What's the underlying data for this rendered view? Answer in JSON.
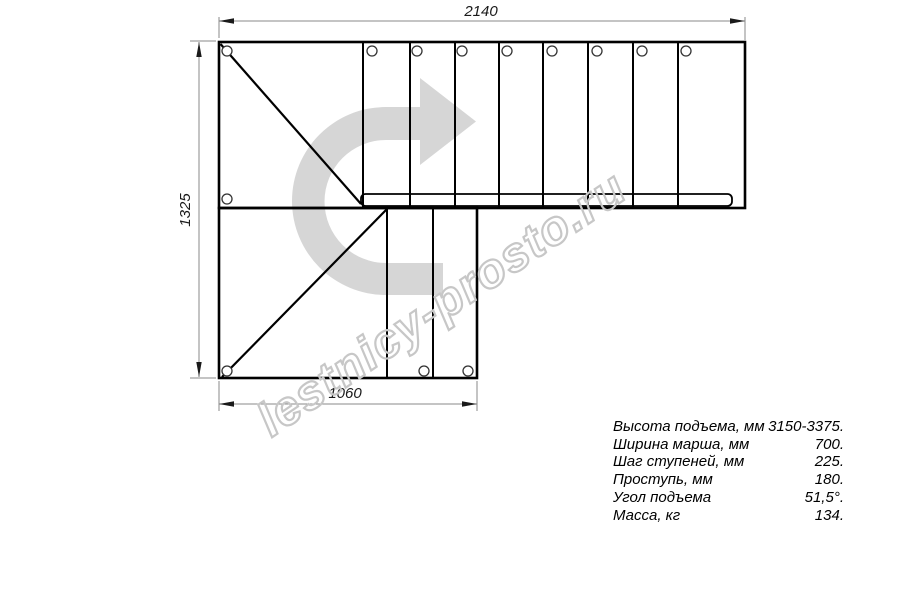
{
  "drawing": {
    "dim_top": "2140",
    "dim_left": "1325",
    "dim_bottom": "1060",
    "watermark_text": "lestnicy-prosto.ru",
    "colors": {
      "line": "#000000",
      "dimension_line": "#8a8a8a",
      "direction_arrow": "#d6d6d6",
      "watermark": "#c7c7c7"
    }
  },
  "specs": [
    {
      "label": "Высота подъема, мм",
      "value": "3150-3375."
    },
    {
      "label": "Ширина марша, мм",
      "value": "700."
    },
    {
      "label": "Шаг ступеней, мм",
      "value": "225."
    },
    {
      "label": "Проступь, мм",
      "value": "180."
    },
    {
      "label": "Угол подъема",
      "value": "51,5°."
    },
    {
      "label": "Масса, кг",
      "value": "134."
    }
  ]
}
